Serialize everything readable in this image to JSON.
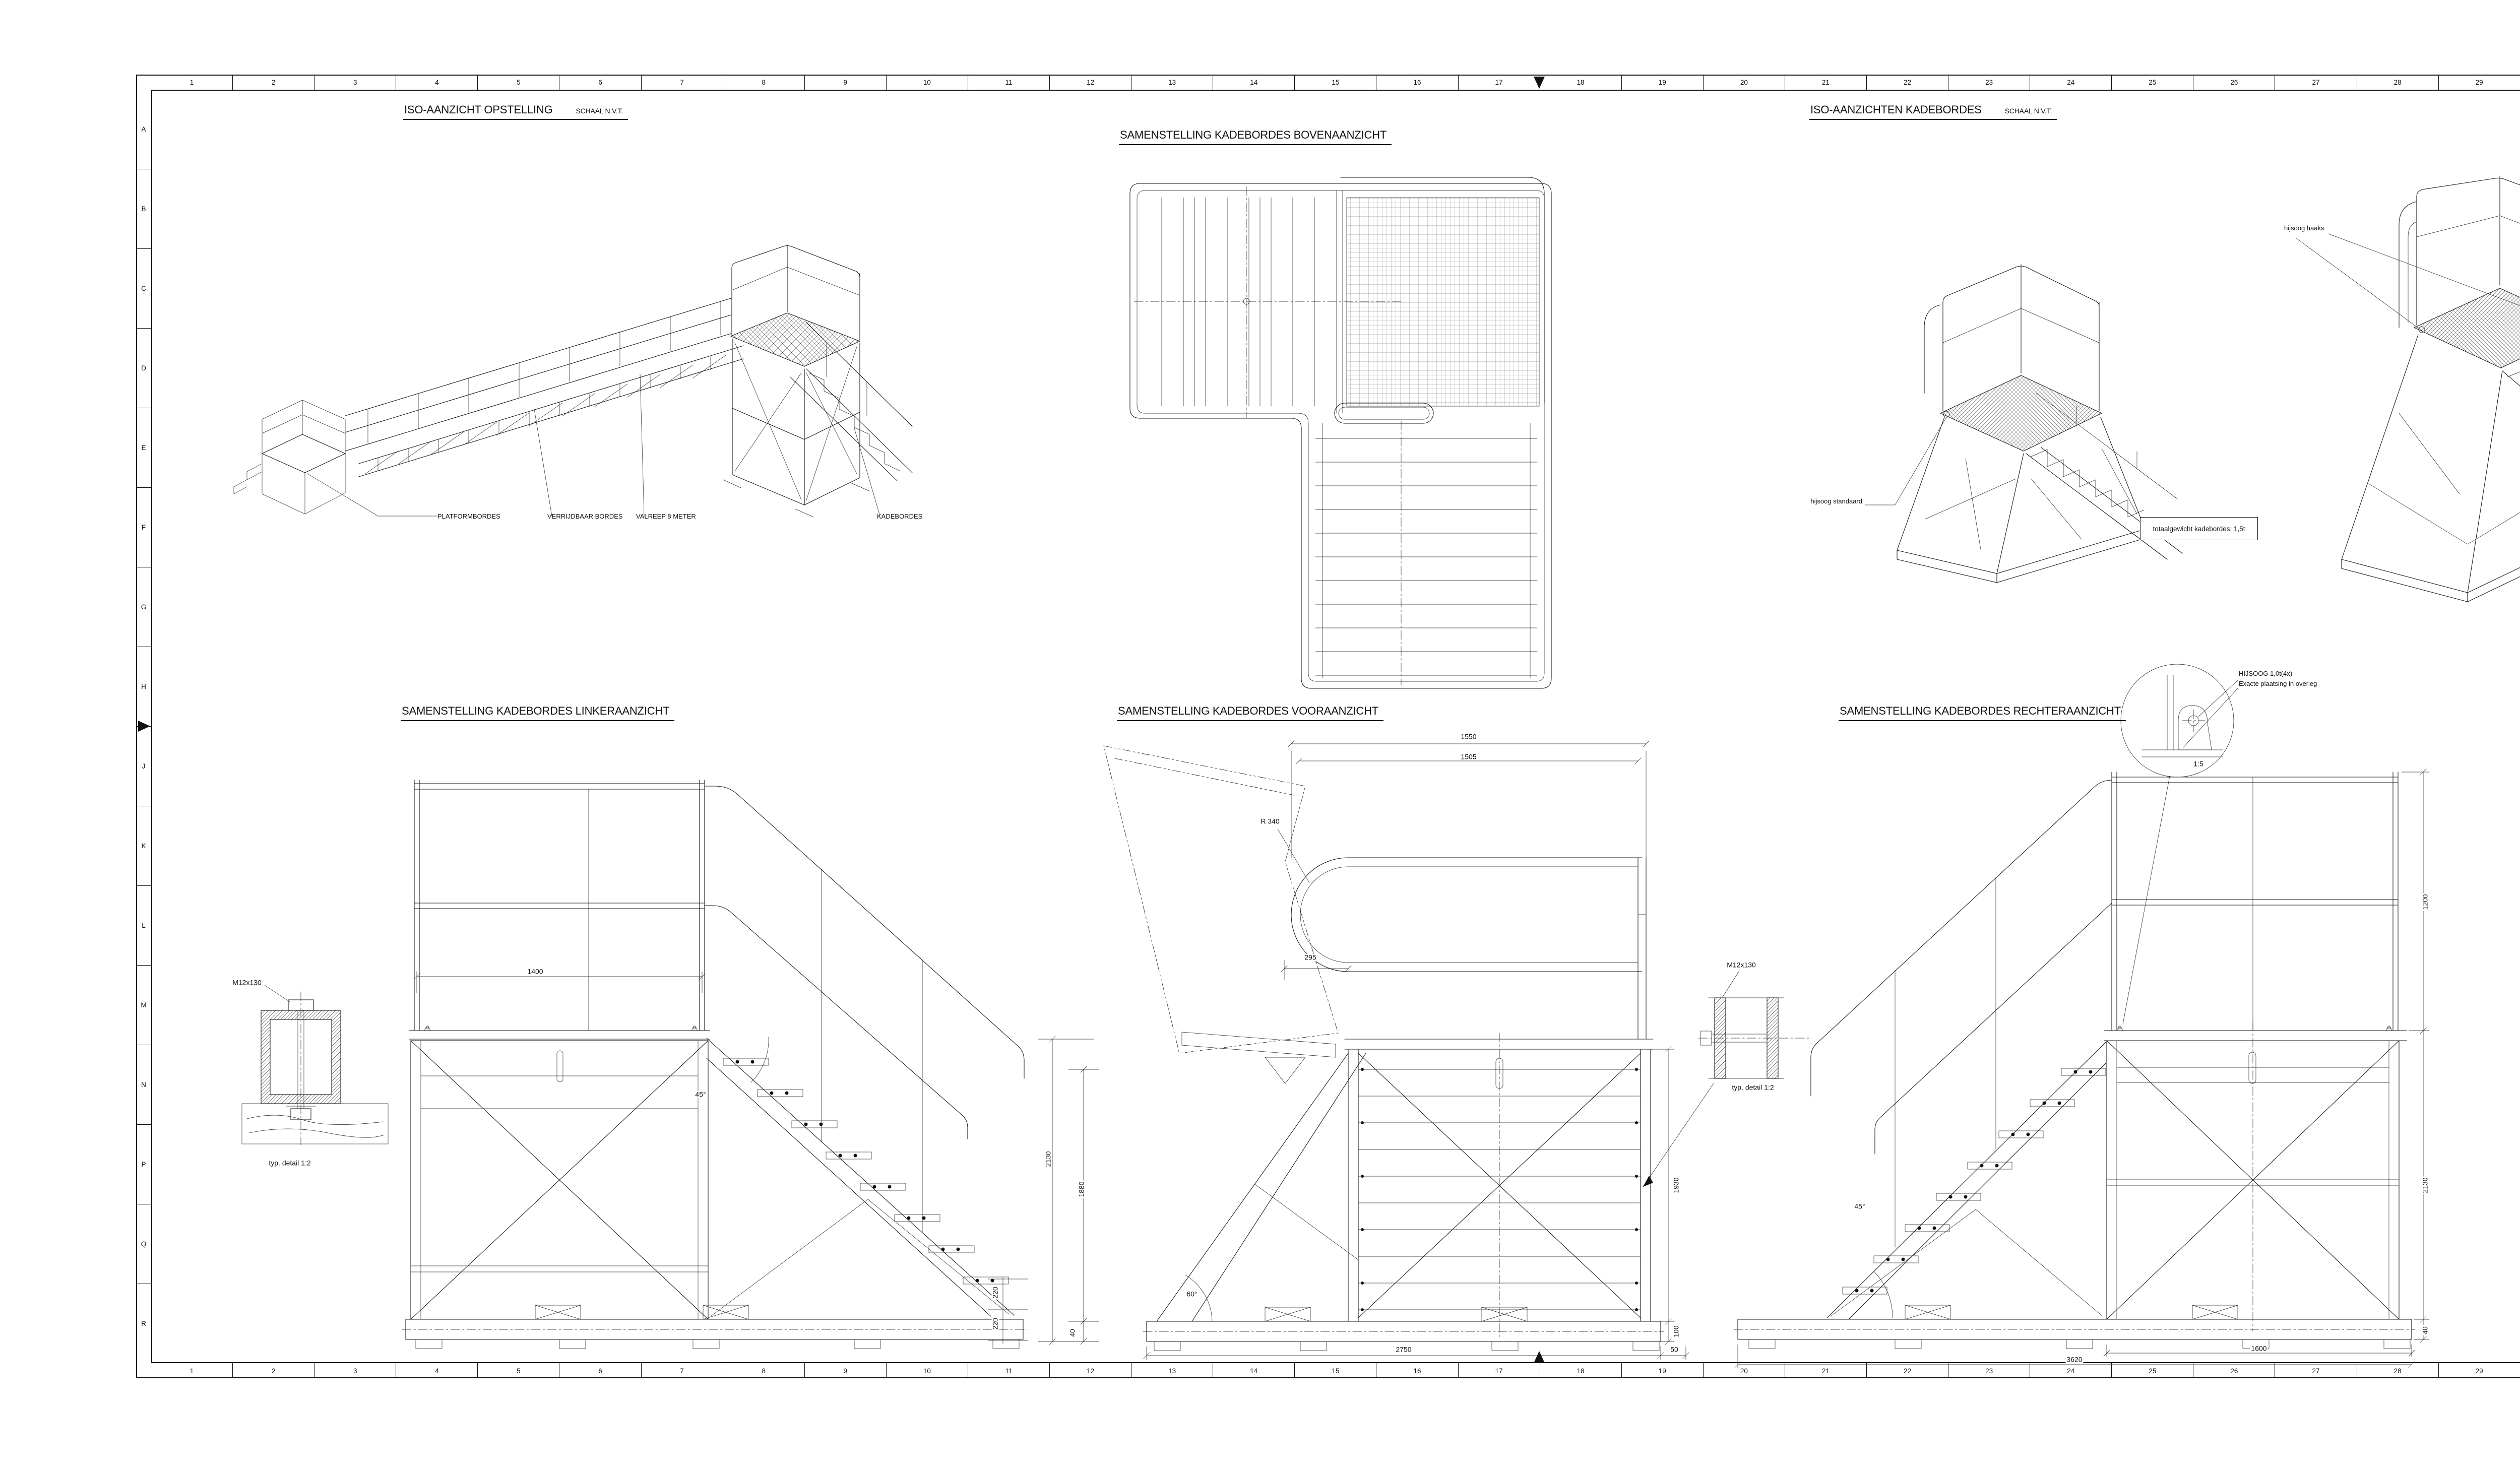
{
  "frame": {
    "columns": [
      "1",
      "2",
      "3",
      "4",
      "5",
      "6",
      "7",
      "8",
      "9",
      "10",
      "11",
      "12",
      "13",
      "14",
      "15",
      "16",
      "17",
      "18",
      "19",
      "20",
      "21",
      "22",
      "23",
      "24",
      "25",
      "26",
      "27",
      "28",
      "29",
      "30",
      "31",
      "32",
      "33",
      "34"
    ],
    "rows": [
      "A",
      "B",
      "C",
      "D",
      "E",
      "F",
      "G",
      "H",
      "J",
      "K",
      "L",
      "M",
      "N",
      "P",
      "Q",
      "R"
    ]
  },
  "views": {
    "iso_opstelling": {
      "title": "ISO-AANZICHT OPSTELLING",
      "scale": "SCHAAL N.V.T.",
      "labels": {
        "platformbordes": "PLATFORMBORDES",
        "verrijdbaar": "VERRIJDBAAR BORDES",
        "valreep": "VALREEP 8 METER",
        "kadebordes": "KADEBORDES"
      }
    },
    "bovenaanzicht": {
      "title": "SAMENSTELLING KADEBORDES BOVENAANZICHT"
    },
    "iso_kadebordes": {
      "title": "ISO-AANZICHTEN KADEBORDES",
      "scale": "SCHAAL N.V.T.",
      "hijsoog_standaard": "hijsoog standaard",
      "hijsoog_haaks": "hijsoog haaks",
      "weight_note": "totaalgewicht kadebordes: 1,5t"
    },
    "linker": {
      "title": "SAMENSTELLING KADEBORDES LINKERAANZICHT",
      "dim_1400": "1400",
      "dim_angle": "45°",
      "dim_220a": "220",
      "dim_220b": "220",
      "detail_label": "M12x130",
      "detail_caption": "typ. detail 1:2"
    },
    "voor": {
      "title": "SAMENSTELLING KADEBORDES VOORAANZICHT",
      "dim_1550": "1550",
      "dim_1505": "1505",
      "dim_r340": "R 340",
      "dim_295": "295",
      "dim_2130": "2130",
      "dim_1880": "1880",
      "dim_40": "40",
      "dim_1930": "1930",
      "dim_100": "100",
      "dim_60": "60°",
      "dim_2750": "2750",
      "dim_50": "50",
      "detail_label": "M12x130",
      "detail_caption": "typ. detail 1:2"
    },
    "rechter": {
      "title": "SAMENSTELLING KADEBORDES RECHTERAANZICHT",
      "note_line1": "HIJSOOG 1,0t(4x)",
      "note_line2": "Exacte plaatsing in overleg",
      "detail_scale": "1:5",
      "dim_1200": "1200",
      "dim_2130": "2130",
      "dim_40": "40",
      "dim_1600": "1600",
      "dim_3620": "3620",
      "dim_angle": "45°"
    }
  },
  "details": {
    "haaks": {
      "title": "HIJSOOG HAAKS 1,0t (3x)",
      "scale": "SCHAAL 1:2",
      "stamp": "SWL 1 TON",
      "d50": "50",
      "dr30": "R 30",
      "d45": "Ø45",
      "d18": "Ø18",
      "d85": "85",
      "d55": "55",
      "d10a": "10",
      "d100": "100",
      "d10b": "10",
      "d8": "8",
      "d18b": "18"
    },
    "standaard": {
      "title": "HIJSOOG STANDAARD 1,0t (1x)",
      "scale": "SCHAAL 1:2",
      "stamp": "SWL 1 TON",
      "d45": "Ø45",
      "d18": "Ø18",
      "dr30": "R 30",
      "d55": "55",
      "d10": "10",
      "d100": "100",
      "d8": "8",
      "d18b": "18"
    }
  },
  "tables": {
    "bijbehorende": {
      "title": "BIJBEHORENDE TEKENINGEN",
      "headers": [
        "TEKENING No.",
        "DOCUMENT TITEL"
      ],
      "rows": [
        [
          "1.92/45.1.01",
          "HULPPLATFORM AFMEREN; KADEBORDES"
        ],
        [
          "1.92/45.1.01",
          "HULPPLATFORM AFMEREN; VERRIJDBAAR BORDES"
        ],
        [
          "1.92/45.1.01",
          "HULPPLATFORM AFMEREN; PLATFORMBORDES"
        ],
        [
          "1.33/36.1.32",
          "VALREEP 8 METER"
        ],
        [
          ".",
          "."
        ]
      ]
    },
    "referentie": {
      "title": "REFERENTIE TEKENINGEN",
      "headers": [
        "REF.No.",
        "TEKENING No.",
        "DOCUMENT TITEL"
      ],
      "rows": [
        [
          "1",
          "1.39/45.1.01 BLAD 002",
          "AFMEERPLAN HOLLANDKLASSE AAN STEIGER 62; NIEUWE FENDERS"
        ],
        [
          "2",
          "1.30/45.1.01 BLAD 308.31",
          "AFMEERPLAN M-FREGAT AAN STEIGER 62"
        ],
        [
          ".",
          ".",
          "."
        ],
        [
          ".",
          ".",
          "."
        ],
        [
          ".",
          ".",
          "."
        ]
      ]
    },
    "wijzigingen": {
      "title": "WIJZIGINGEN",
      "headers": [
        "WIJZ",
        "REF. NUMMER",
        "OMSCHRIJVING VAN DE WIJZIGING",
        "GET.",
        "GEC.",
        "AKK. NAAM",
        "PAR.",
        "AFD.",
        "DATUM"
      ],
      "rows": [
        [
          ".",
          ".",
          ".",
          ".",
          ".",
          ".",
          ".",
          ".",
          "."
        ],
        [
          ".",
          ".",
          ".",
          ".",
          ".",
          ".",
          ".",
          ".",
          "."
        ]
      ]
    },
    "engineer": {
      "title": "ENGINEER / OPDRACHTGEVER (AKKOORD)",
      "headers": [
        "",
        "REF. NUMMER",
        "OMSCHRIJVING / OPMERKING",
        "AKK. NAAM",
        "PAR.",
        "AFD.",
        "DATUM"
      ],
      "row": {
        "org": "ORG",
        "ref": "12075641",
        "omschrijving": "HULPMATERIAAL AFMEREN MFF/OPV",
        "naam": "R. Huele",
        "afd": "FF",
        "datum": "11/19"
      }
    }
  },
  "titleblock": {
    "ismi_label": "ISMI",
    "ismi_value": "1000",
    "schip_label": "SCHIP/DIENST",
    "schip": "MARINEBEDRIJF DIVISIE PLATFORM",
    "doc_label": "DOC. TITEL",
    "doc": "HULPPLATFORMS TBV AFMEREN MFF/OPV; KADEBORDES SAMENSTELLING",
    "proj_label": "PROJ.",
    "vvkm_label": "VVKM. NR.",
    "ukc_label": "UKC",
    "ukc": "9101",
    "toep_label": "TOEP CODE",
    "var_label": "VAR. LET.",
    "var": "A",
    "fab_label": "FAB. DOC. NR.",
    "fab": "1.92/45.1.01",
    "cofile_label": "CO-FILENAAM:",
    "cofile": "c20004023.dgn",
    "blad_label": "Blad Nr:",
    "blad": "002",
    "org_lines": [
      "CZSK / DMI / AMT",
      "Techniekgroep C4I & NB",
      "Sectie Nieuwbouw & Ontwikkeling",
      "Ministerie van Defensie"
    ],
    "fcn_label": "FCN",
    "fcn": "H1174",
    "ts_label": "TS",
    "ts": "SAT",
    "form_label": "FORM.",
    "form": "A0*",
    "schaal_label": "SCHAAL",
    "schaal": "1:10",
    "get_label": "GET.",
    "get": "M. Pronk",
    "get_date": "10-19",
    "gec_label": "GEC.",
    "gec": "L. de Klerk",
    "gec_date": "10-19",
    "gez_label": "GEZ.",
    "gez": "N. Tuin",
    "gez_date": "10-19",
    "wijz_label": "WIJZ.",
    "watermark": "TER INFO"
  }
}
